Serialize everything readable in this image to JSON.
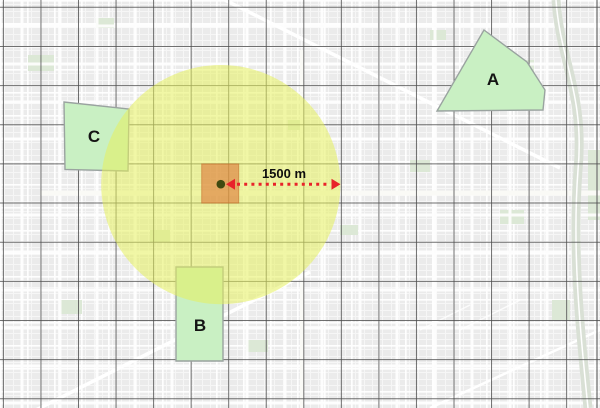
{
  "map": {
    "background_color": "#ebebeb",
    "grid": {
      "color": "#4d4d4d",
      "opacity": 0.8,
      "width": 1,
      "vertical": {
        "start": 3.4,
        "step": 37.55,
        "count": 16
      },
      "horizontal": {
        "start": 7.3,
        "step": 39.15,
        "count": 11
      }
    },
    "buffer_circle": {
      "cx": 220.8,
      "cy": 184.6,
      "r": 119.6,
      "fill": "#e5f05c",
      "opacity": 0.55
    },
    "center_cell": {
      "x": 201.7,
      "y": 163.9,
      "width": 37,
      "height": 39.2,
      "fill": "#dd7232",
      "opacity": 0.58,
      "stroke": "#c05f1d"
    },
    "center_point": {
      "cx": 220.8,
      "cy": 184.2,
      "r": 4.3,
      "fill": "#3f4a10"
    },
    "distance_arrow": {
      "label": "1500 m",
      "color": "#e8232a",
      "y": 184.2,
      "tail_x": 226,
      "head_x": 340.5,
      "dash_start": 237,
      "dash_end": 330,
      "half_height": 5.5,
      "head_len": 9,
      "label_x": 284,
      "label_y": 178
    },
    "zone_style": {
      "fill": "#c9f0c3",
      "stroke": "#9aa3a0",
      "stroke_width": 1.4
    },
    "zones": [
      {
        "label": "A",
        "points": "484,30 527,62 545,90 543,110 437,111",
        "label_x": 493,
        "label_y": 85,
        "layer": "over"
      },
      {
        "label": "B",
        "points": "176,267 223,267 223,361 176,361",
        "label_x": 200,
        "label_y": 331,
        "layer": "under"
      },
      {
        "label": "C",
        "points": "64,102 129,109 128,171 65,169.5",
        "label_x": 94,
        "label_y": 142,
        "layer": "under"
      }
    ]
  }
}
